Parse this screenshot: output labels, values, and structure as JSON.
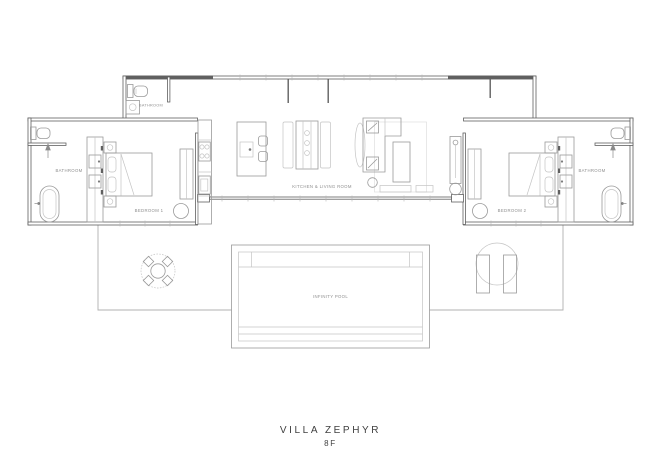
{
  "title": {
    "name": "VILLA ZEPHYR",
    "floor": "8F"
  },
  "rooms": {
    "powder_bathroom": "BATHROOM",
    "bathroom_left": "BATHROOM",
    "bedroom_left": "BEDROOM 1",
    "kitchen_living": "KITCHEN & LIVING ROOM",
    "bedroom_right": "BEDROOM 2",
    "bathroom_right": "BATHROOM",
    "pool": "INFINITY POOL"
  },
  "colors": {
    "background": "#ffffff",
    "wall": "#606060",
    "furniture": "#9a9a9a",
    "light": "#c4c4c4",
    "deck": "#b0b0b0",
    "label": "#8f8f8f",
    "title": "#3f3f3f"
  }
}
